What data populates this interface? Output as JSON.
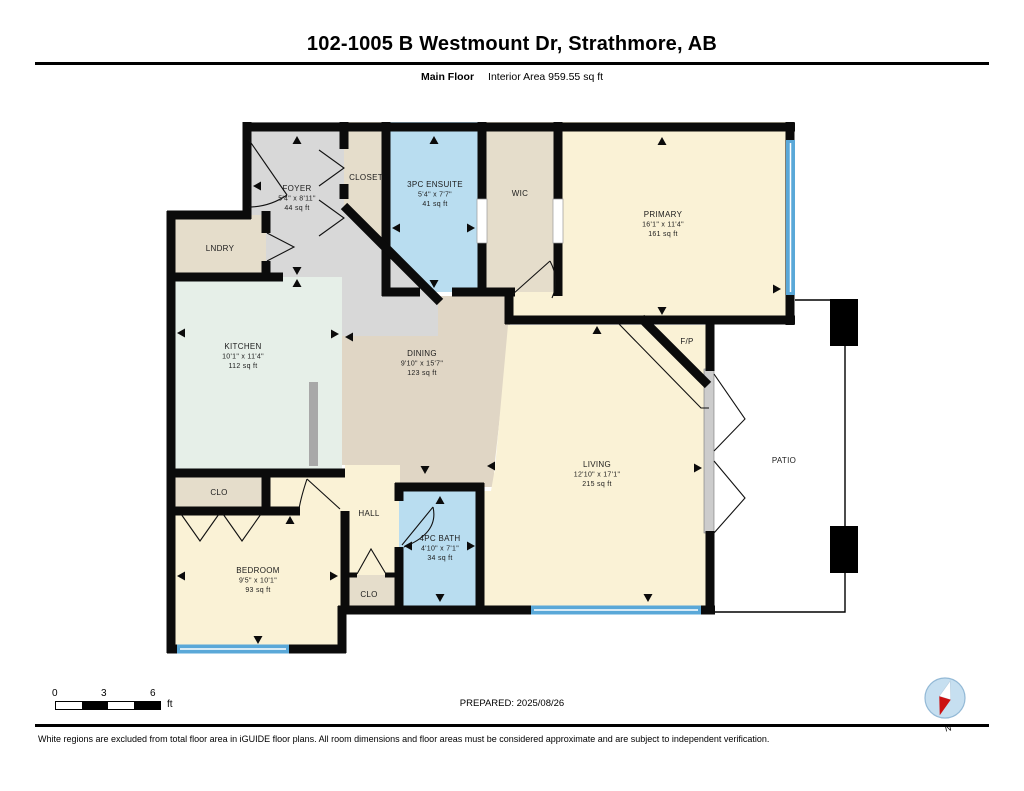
{
  "header": {
    "title": "102-1005 B Westmount Dr, Strathmore, AB",
    "floor_label": "Main Floor",
    "area_label": "Interior Area 959.55 sq ft"
  },
  "plan": {
    "rooms": [
      {
        "id": "foyer",
        "name": "FOYER",
        "dims": "5'4\" x 8'11\"",
        "area": "44 sq ft"
      },
      {
        "id": "closet",
        "name": "CLOSET"
      },
      {
        "id": "ensuite",
        "name": "3PC ENSUITE",
        "dims": "5'4\" x 7'7\"",
        "area": "41 sq ft"
      },
      {
        "id": "wic",
        "name": "WIC"
      },
      {
        "id": "primary",
        "name": "PRIMARY",
        "dims": "16'1\" x 11'4\"",
        "area": "161 sq ft"
      },
      {
        "id": "lndry",
        "name": "LNDRY"
      },
      {
        "id": "kitchen",
        "name": "KITCHEN",
        "dims": "10'1\" x 11'4\"",
        "area": "112 sq ft"
      },
      {
        "id": "dining",
        "name": "DINING",
        "dims": "9'10\" x 15'7\"",
        "area": "123 sq ft"
      },
      {
        "id": "fp",
        "name": "F/P"
      },
      {
        "id": "living",
        "name": "LIVING",
        "dims": "12'10\" x 17'1\"",
        "area": "215 sq ft"
      },
      {
        "id": "patio",
        "name": "PATIO"
      },
      {
        "id": "clo1",
        "name": "CLO"
      },
      {
        "id": "hall",
        "name": "HALL"
      },
      {
        "id": "bedroom",
        "name": "BEDROOM",
        "dims": "9'5\" x 10'1\"",
        "area": "93 sq ft"
      },
      {
        "id": "bath",
        "name": "4PC BATH",
        "dims": "4'10\" x 7'1\"",
        "area": "34 sq ft"
      },
      {
        "id": "clo2",
        "name": "CLO"
      }
    ]
  },
  "colors": {
    "wall": "#0b0b0b",
    "cream": "#faf2d6",
    "blue": "#b9ddf0",
    "beige": "#e5ddcb",
    "gray": "#d8d8d8",
    "mint": "#e6efe8",
    "taupe": "#e0d6c5",
    "window": "#5aa8d8",
    "counter": "#a8a8a8",
    "compassBlue": "#c6dff0",
    "compassRed": "#cc1111"
  },
  "footer": {
    "prepared": "PREPARED: 2025/08/26",
    "scale": {
      "ticks": [
        "0",
        "3",
        "6"
      ],
      "unit": "ft"
    },
    "compass_label": "N"
  },
  "disclaimer": "White regions are excluded from total floor area in iGUIDE floor plans. All room dimensions and floor areas must be considered approximate and are subject to independent verification."
}
